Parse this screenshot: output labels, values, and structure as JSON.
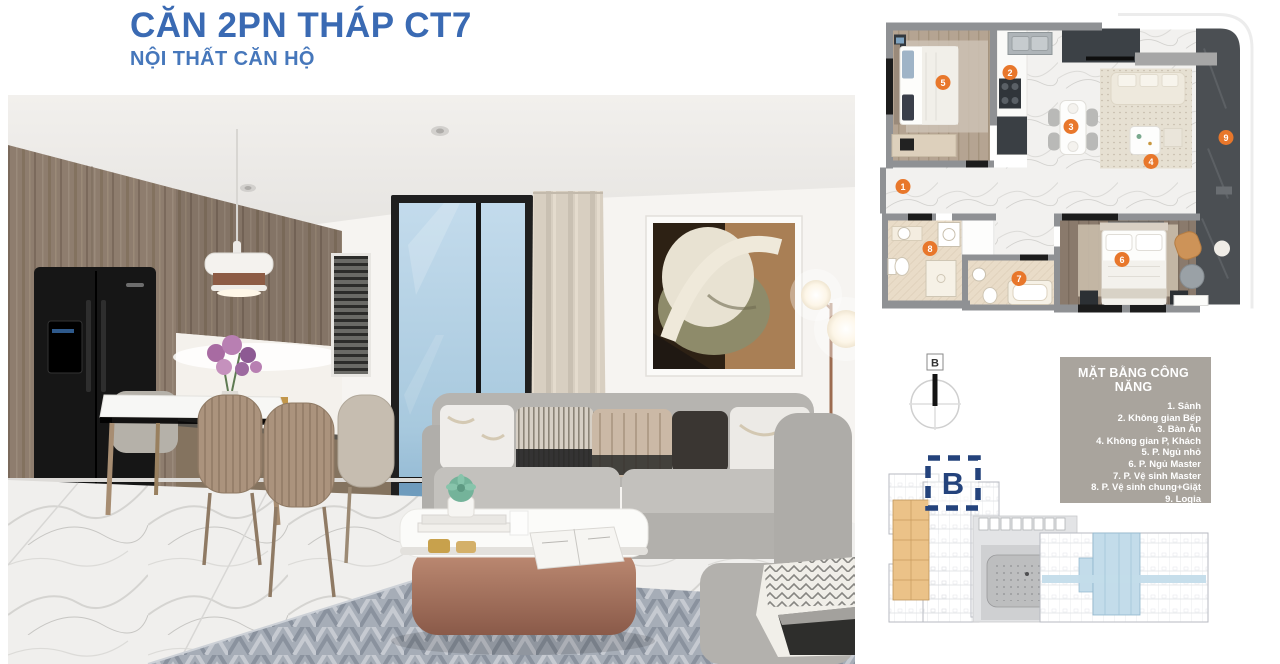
{
  "page": {
    "title": "CĂN 2PN THÁP CT7",
    "subtitle": "NỘI THẤT CĂN HỘ",
    "title_color": "#3a6ab3",
    "subtitle_color": "#4677bb",
    "background": "#ffffff"
  },
  "floor_plan": {
    "marker_color": "#e8772b",
    "markers": [
      "1",
      "2",
      "3",
      "4",
      "5",
      "6",
      "7",
      "8",
      "9"
    ]
  },
  "compass": {
    "label": "B"
  },
  "legend": {
    "title": "MẶT BẰNG CÔNG NĂNG",
    "items": [
      "1. Sảnh",
      "2. Không gian Bếp",
      "3. Bàn Ăn",
      "4. Không gian P, Khách",
      "5. P. Ngủ nhỏ",
      "6. P. Ngủ Master",
      "7. P. Vệ sinh Master",
      "8. P. Vệ sinh chung+Giặt",
      "9. Logia"
    ],
    "bg_color": "#a9a49d",
    "text_color": "#ffffff"
  },
  "site_plan": {
    "block_label": "B",
    "block_label_color": "#24437c",
    "highlight_orange": "#ebc288",
    "highlight_blue": "#c3dcea"
  }
}
